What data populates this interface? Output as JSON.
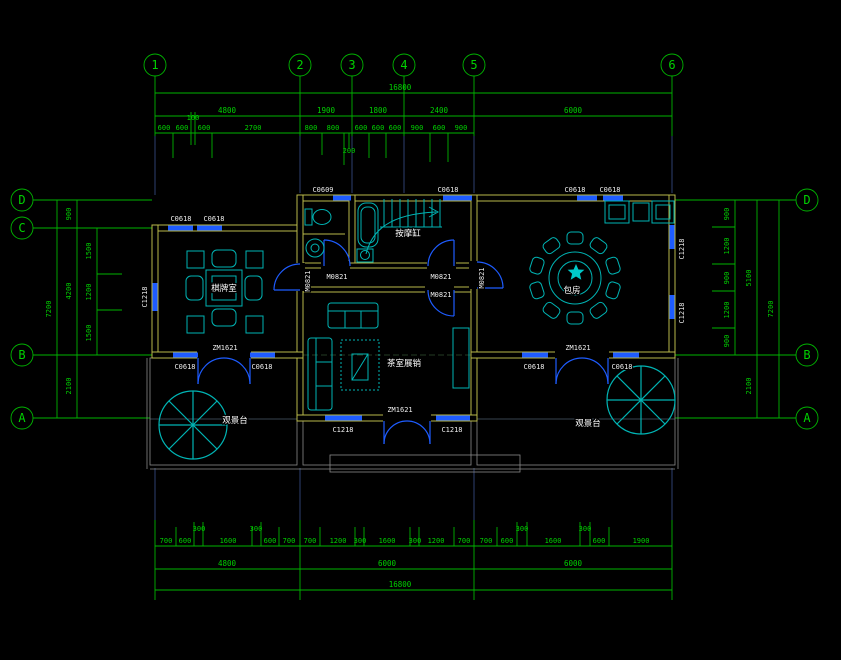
{
  "colors": {
    "background": "#000000",
    "grid_green": "#00b400",
    "wall_yellow": "#b9b94a",
    "opening_blue": "#1e5cff",
    "fixture_cyan": "#00b4b4",
    "deck_gray": "#8a8a8a",
    "label_white": "#ececec",
    "axis_stub_blue": "#2e4070"
  },
  "axis_bubbles": {
    "top": [
      "1",
      "2",
      "3",
      "4",
      "5",
      "6"
    ],
    "left": [
      "D",
      "C",
      "B",
      "A"
    ],
    "right": [
      "D",
      "B",
      "A"
    ]
  },
  "room_labels": {
    "card_room": "棋牌室",
    "private_room": "包房",
    "tea_room": "茶室展销",
    "bath_tub": "按摩缸",
    "deck_left": "观景台",
    "deck_right": "观景台"
  },
  "opening_labels": {
    "c0609": "C0609",
    "c0618": "C0618",
    "c1218": "C1218",
    "m0821": "M0821",
    "zm1621": "ZM1621"
  },
  "dimensions": {
    "top_total": "16800",
    "top_segments": [
      "4800",
      "1900",
      "1800",
      "2400",
      "6000"
    ],
    "top_sub": [
      "600",
      "600",
      "100",
      "600",
      "2700",
      "800",
      "800",
      "200",
      "600",
      "600",
      "600",
      "900",
      "600",
      "900"
    ],
    "bottom_total": "16800",
    "bottom_segments": [
      "4800",
      "6000",
      "6000"
    ],
    "bottom_sub_left": [
      "700",
      "600",
      "300",
      "1600",
      "300",
      "600",
      "700"
    ],
    "bottom_sub_mid": [
      "700",
      "1200",
      "300",
      "1600",
      "300",
      "1200",
      "700"
    ],
    "bottom_sub_right": [
      "700",
      "600",
      "300",
      "1600",
      "300",
      "600",
      "1900"
    ],
    "left_total": "7200",
    "left_mid": [
      "900",
      "4200",
      "2100"
    ],
    "left_sub": [
      "1500",
      "1200",
      "1500"
    ],
    "right_total": "7200",
    "right_mid": [
      "5100",
      "2100"
    ],
    "right_sub": [
      "900",
      "1200",
      "900",
      "1200",
      "900"
    ]
  }
}
